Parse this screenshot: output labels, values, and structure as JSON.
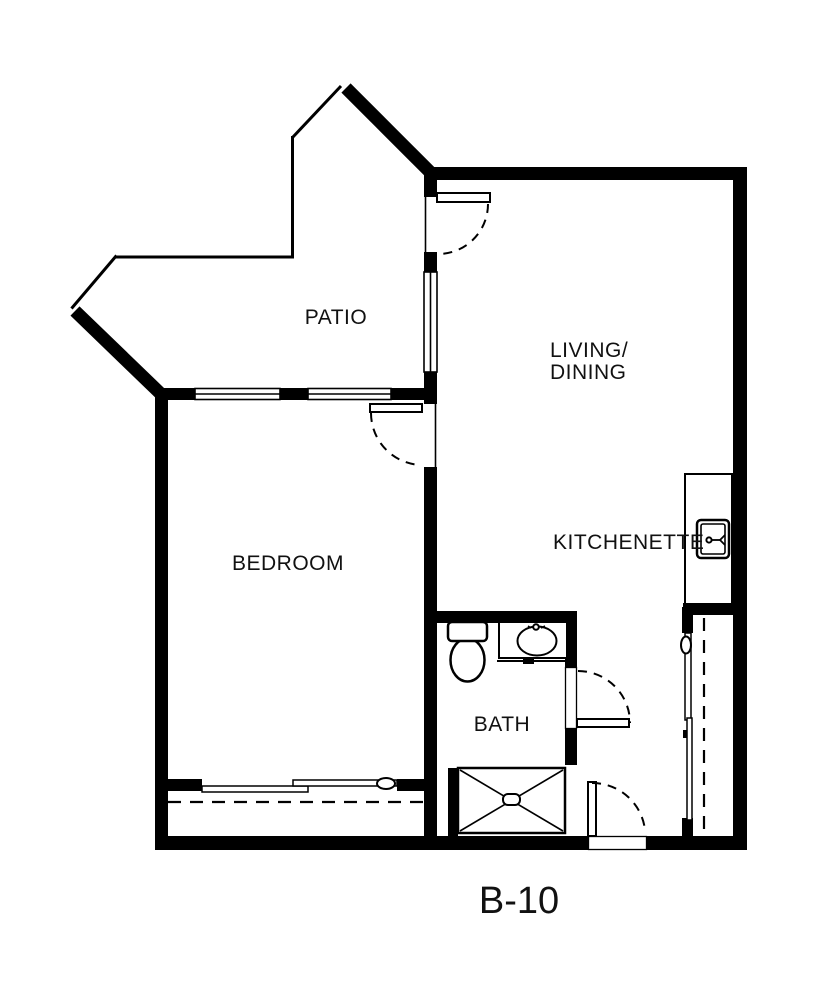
{
  "canvas": {
    "width": 818,
    "height": 998,
    "background": "#ffffff",
    "wall_color": "#000000",
    "text_color": "#111111"
  },
  "labels": {
    "patio": "PATIO",
    "living_line1": "LIVING/",
    "living_line2": "DINING",
    "kitchenette": "KITCHENETTE",
    "bedroom": "BEDROOM",
    "bath": "BATH",
    "unit": "B-10"
  },
  "fixtures": [
    "toilet",
    "bathroom-sink-counter",
    "shower-pan",
    "kitchen-sink",
    "patio-swing-door",
    "bedroom-swing-door",
    "bath-swing-door",
    "entry-swing-door",
    "bedroom-closet-sliding-doors",
    "hall-closet-sliding-doors",
    "patio-window-left",
    "patio-window-right",
    "patio-side-window"
  ]
}
